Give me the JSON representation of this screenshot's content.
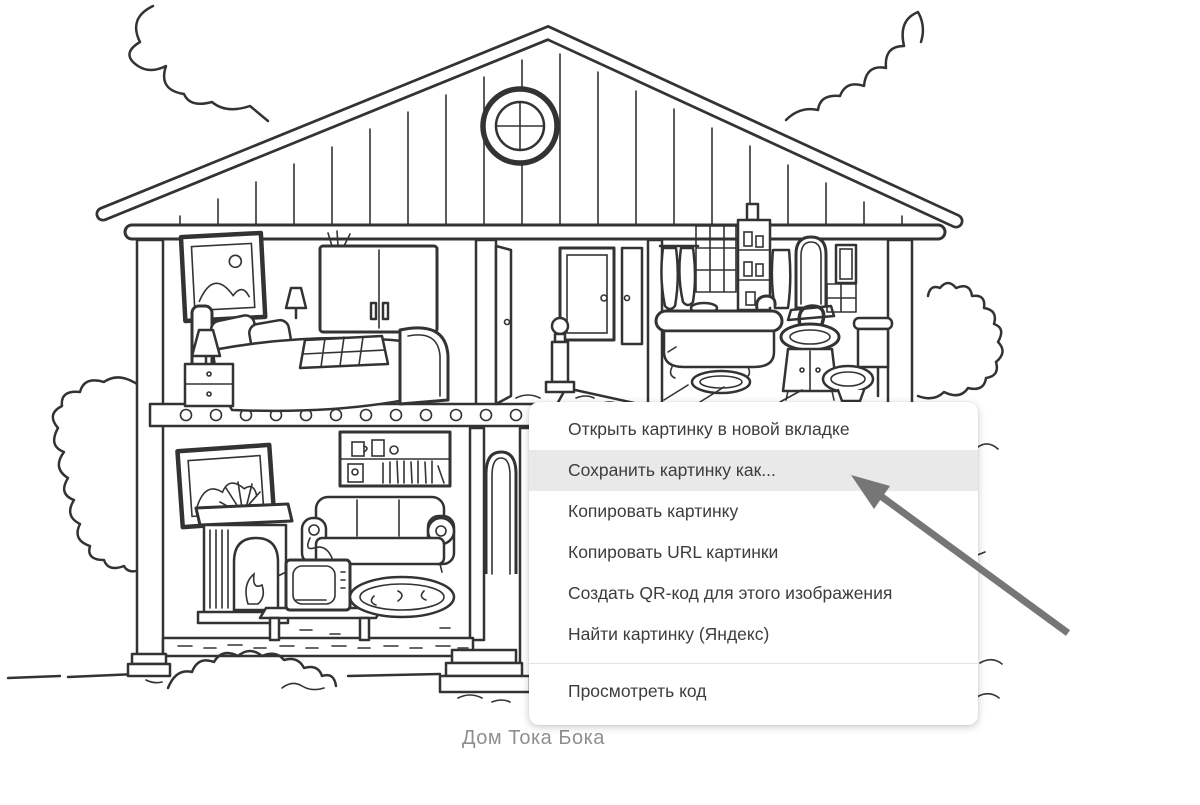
{
  "illustration": {
    "alt": "Раскраска: двухэтажный кукольный дом в разрезе (спальня, прихожая, ванная, гостиная)",
    "caption": "Дом Тока Бока"
  },
  "context_menu": {
    "items": [
      {
        "label": "Открыть картинку в новой вкладке",
        "highlighted": false
      },
      {
        "label": "Сохранить картинку как...",
        "highlighted": true
      },
      {
        "label": "Копировать картинку",
        "highlighted": false
      },
      {
        "label": "Копировать URL картинки",
        "highlighted": false
      },
      {
        "label": "Создать QR-код для этого изображения",
        "highlighted": false
      },
      {
        "label": "Найти картинку (Яндекс)",
        "highlighted": false
      },
      {
        "label": "Просмотреть код",
        "highlighted": false
      }
    ]
  },
  "annotation": {
    "arrow_points_to": "Сохранить картинку как..."
  },
  "colors": {
    "page_bg": "#ffffff",
    "menu_bg": "#ffffff",
    "menu_text": "#3d3d3d",
    "menu_highlight": "#e9e9e9",
    "menu_separator": "#e2e2e2",
    "arrow": "#767676",
    "caption_text": "#8f8f8f",
    "drawing_line": "#333333"
  }
}
